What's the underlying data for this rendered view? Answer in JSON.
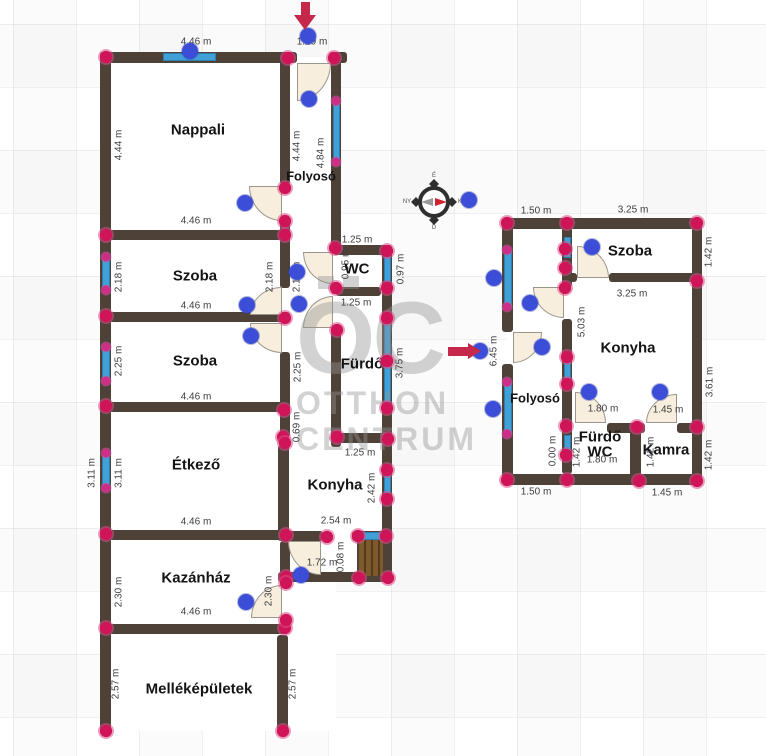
{
  "page": {
    "background": "#ffffff",
    "grid_color": "#ececec",
    "grid_size_px": 63
  },
  "colors": {
    "wall": "#4e4138",
    "window": "#41a0d6",
    "window_border": "#2c7fb0",
    "door_fill": "#f7eedd",
    "door_border": "#9a968c",
    "corner_dot": "#d01458",
    "window_dot": "#cb2f87",
    "handle_dot": "#3c4ed8",
    "arrow": "#c5284a",
    "label_text": "#3d3d3d",
    "room_text": "#141414",
    "watermark": "#949494",
    "stairs": "#7d5a2c",
    "stairs_stripe": "#573a1a"
  },
  "watermark": {
    "monogram": "OC",
    "line1": "OTTHON",
    "line2": "CENTRUM"
  },
  "compass": {
    "north": "É",
    "south": "D",
    "east": "K",
    "west": "NY"
  },
  "floorplan": {
    "interiors": [
      [
        106,
        57,
        230,
        674
      ],
      [
        336,
        245,
        51,
        333
      ],
      [
        507,
        223,
        191,
        258
      ]
    ],
    "walls": [
      [
        100,
        52,
        197,
        11
      ],
      [
        329,
        52,
        18,
        11
      ],
      [
        100,
        52,
        11,
        679
      ],
      [
        100,
        230,
        190,
        10
      ],
      [
        100,
        312,
        190,
        10
      ],
      [
        100,
        402,
        190,
        10
      ],
      [
        100,
        530,
        190,
        10
      ],
      [
        100,
        624,
        188,
        10
      ],
      [
        280,
        52,
        10,
        133
      ],
      [
        280,
        220,
        10,
        68
      ],
      [
        280,
        352,
        10,
        85
      ],
      [
        278,
        445,
        11,
        96
      ],
      [
        280,
        541,
        10,
        44
      ],
      [
        280,
        618,
        10,
        6
      ],
      [
        277,
        635,
        11,
        96
      ],
      [
        331,
        52,
        10,
        198
      ],
      [
        331,
        284,
        10,
        10
      ],
      [
        331,
        328,
        10,
        119
      ],
      [
        333,
        245,
        59,
        10
      ],
      [
        336,
        287,
        45,
        9
      ],
      [
        382,
        245,
        10,
        337
      ],
      [
        331,
        433,
        61,
        10
      ],
      [
        278,
        531,
        45,
        10
      ],
      [
        352,
        531,
        40,
        10
      ],
      [
        278,
        572,
        114,
        10
      ],
      [
        502,
        218,
        200,
        11
      ],
      [
        502,
        218,
        11,
        114
      ],
      [
        502,
        364,
        11,
        121
      ],
      [
        692,
        218,
        10,
        267
      ],
      [
        502,
        474,
        200,
        11
      ],
      [
        562,
        218,
        10,
        69
      ],
      [
        562,
        319,
        10,
        155
      ],
      [
        562,
        273,
        15,
        9
      ],
      [
        609,
        273,
        93,
        9
      ],
      [
        607,
        423,
        38,
        10
      ],
      [
        677,
        423,
        25,
        10
      ],
      [
        630,
        423,
        11,
        62
      ]
    ],
    "windows": [
      [
        163,
        53,
        53,
        8
      ],
      [
        102,
        256,
        8,
        35
      ],
      [
        102,
        346,
        8,
        36
      ],
      [
        102,
        452,
        8,
        37
      ],
      [
        333,
        103,
        7,
        59
      ],
      [
        384,
        252,
        7,
        30
      ],
      [
        384,
        322,
        7,
        38
      ],
      [
        384,
        365,
        7,
        40
      ],
      [
        384,
        470,
        7,
        27
      ],
      [
        356,
        532,
        28,
        8
      ],
      [
        504,
        251,
        8,
        57
      ],
      [
        504,
        382,
        8,
        53
      ],
      [
        564,
        237,
        7,
        21
      ],
      [
        564,
        352,
        7,
        33
      ],
      [
        564,
        435,
        7,
        23
      ]
    ],
    "doors": [
      {
        "x": 297,
        "y": 63,
        "w": 34,
        "h": 38,
        "corner": "br"
      },
      {
        "x": 249,
        "y": 186,
        "w": 33,
        "h": 35,
        "corner": "bl"
      },
      {
        "x": 250,
        "y": 287,
        "w": 32,
        "h": 28,
        "corner": "tl"
      },
      {
        "x": 250,
        "y": 323,
        "w": 32,
        "h": 30,
        "corner": "bl"
      },
      {
        "x": 303,
        "y": 252,
        "w": 30,
        "h": 32,
        "corner": "bl"
      },
      {
        "x": 303,
        "y": 296,
        "w": 30,
        "h": 32,
        "corner": "tl"
      },
      {
        "x": 288,
        "y": 541,
        "w": 33,
        "h": 34,
        "corner": "bl"
      },
      {
        "x": 251,
        "y": 585,
        "w": 31,
        "h": 33,
        "corner": "tl"
      },
      {
        "x": 577,
        "y": 246,
        "w": 32,
        "h": 32,
        "corner": "tr"
      },
      {
        "x": 533,
        "y": 287,
        "w": 31,
        "h": 31,
        "corner": "bl"
      },
      {
        "x": 513,
        "y": 332,
        "w": 29,
        "h": 31,
        "corner": "br"
      },
      {
        "x": 575,
        "y": 392,
        "w": 31,
        "h": 31,
        "corner": "tr"
      },
      {
        "x": 646,
        "y": 394,
        "w": 31,
        "h": 29,
        "corner": "tl"
      }
    ],
    "stairs": {
      "x": 357,
      "y": 534,
      "w": 28,
      "h": 44
    },
    "corner_dots": [
      [
        106,
        57
      ],
      [
        288,
        58
      ],
      [
        334,
        58
      ],
      [
        106,
        235
      ],
      [
        285,
        235
      ],
      [
        285,
        188
      ],
      [
        285,
        221
      ],
      [
        106,
        316
      ],
      [
        285,
        318
      ],
      [
        106,
        406
      ],
      [
        284,
        410
      ],
      [
        283,
        437
      ],
      [
        285,
        443
      ],
      [
        106,
        534
      ],
      [
        286,
        535
      ],
      [
        106,
        628
      ],
      [
        285,
        628
      ],
      [
        106,
        731
      ],
      [
        283,
        731
      ],
      [
        335,
        248
      ],
      [
        336,
        288
      ],
      [
        337,
        330
      ],
      [
        387,
        251
      ],
      [
        387,
        288
      ],
      [
        387,
        318
      ],
      [
        387,
        361
      ],
      [
        387,
        408
      ],
      [
        337,
        437
      ],
      [
        388,
        439
      ],
      [
        387,
        470
      ],
      [
        387,
        499
      ],
      [
        327,
        537
      ],
      [
        358,
        536
      ],
      [
        386,
        536
      ],
      [
        286,
        577
      ],
      [
        359,
        578
      ],
      [
        388,
        578
      ],
      [
        286,
        583
      ],
      [
        286,
        620
      ],
      [
        507,
        223
      ],
      [
        567,
        223
      ],
      [
        697,
        223
      ],
      [
        565,
        249
      ],
      [
        565,
        268
      ],
      [
        565,
        288
      ],
      [
        697,
        281
      ],
      [
        567,
        357
      ],
      [
        567,
        384
      ],
      [
        566,
        426
      ],
      [
        637,
        427
      ],
      [
        697,
        427
      ],
      [
        566,
        455
      ],
      [
        507,
        480
      ],
      [
        567,
        480
      ],
      [
        639,
        481
      ],
      [
        697,
        481
      ]
    ],
    "window_dots": [
      [
        106,
        257
      ],
      [
        106,
        290
      ],
      [
        106,
        347
      ],
      [
        106,
        381
      ],
      [
        106,
        453
      ],
      [
        106,
        488
      ],
      [
        336,
        101
      ],
      [
        336,
        162
      ],
      [
        507,
        250
      ],
      [
        507,
        307
      ],
      [
        507,
        382
      ],
      [
        507,
        434
      ]
    ],
    "handle_dots": [
      [
        190,
        51
      ],
      [
        308,
        36
      ],
      [
        309,
        99
      ],
      [
        245,
        203
      ],
      [
        247,
        305
      ],
      [
        251,
        336
      ],
      [
        297,
        272
      ],
      [
        299,
        304
      ],
      [
        469,
        200
      ],
      [
        480,
        351
      ],
      [
        301,
        575
      ],
      [
        246,
        602
      ],
      [
        494,
        278
      ],
      [
        530,
        303
      ],
      [
        592,
        247
      ],
      [
        542,
        347
      ],
      [
        493,
        409
      ],
      [
        589,
        392
      ],
      [
        660,
        392
      ]
    ],
    "rooms": [
      {
        "name": "Nappali",
        "x": 198,
        "y": 130,
        "small": false
      },
      {
        "name": "Folyosó",
        "x": 311,
        "y": 176,
        "small": true
      },
      {
        "name": "Szoba",
        "x": 195,
        "y": 276,
        "small": false
      },
      {
        "name": "Szoba",
        "x": 195,
        "y": 361,
        "small": false
      },
      {
        "name": "WC",
        "x": 357,
        "y": 269,
        "small": false
      },
      {
        "name": "Fürdő",
        "x": 362,
        "y": 364,
        "small": false
      },
      {
        "name": "Étkező",
        "x": 196,
        "y": 465,
        "small": false
      },
      {
        "name": "Konyha",
        "x": 335,
        "y": 485,
        "small": false
      },
      {
        "name": "Kazánház",
        "x": 196,
        "y": 578,
        "small": false
      },
      {
        "name": "Melléképületek",
        "x": 199,
        "y": 689,
        "small": false
      },
      {
        "name": "Szoba",
        "x": 630,
        "y": 251,
        "small": false
      },
      {
        "name": "Konyha",
        "x": 628,
        "y": 348,
        "small": false
      },
      {
        "name": "Folyosó",
        "x": 535,
        "y": 398,
        "small": true
      },
      {
        "name": "Fürdő",
        "x": 600,
        "y": 437,
        "small": false
      },
      {
        "name": "WC",
        "x": 600,
        "y": 452,
        "small": false
      },
      {
        "name": "Kamra",
        "x": 666,
        "y": 450,
        "small": false
      }
    ],
    "measurements": [
      {
        "text": "4.46 m",
        "x": 196,
        "y": 42,
        "v": false
      },
      {
        "text": "1.29 m",
        "x": 312,
        "y": 42,
        "v": false
      },
      {
        "text": "4.46 m",
        "x": 196,
        "y": 221,
        "v": false
      },
      {
        "text": "4.46 m",
        "x": 196,
        "y": 306,
        "v": false
      },
      {
        "text": "4.46 m",
        "x": 196,
        "y": 397,
        "v": false
      },
      {
        "text": "4.46 m",
        "x": 196,
        "y": 522,
        "v": false
      },
      {
        "text": "4.46 m",
        "x": 196,
        "y": 612,
        "v": false
      },
      {
        "text": "1.25 m",
        "x": 357,
        "y": 240,
        "v": false
      },
      {
        "text": "1.25 m",
        "x": 356,
        "y": 303,
        "v": false
      },
      {
        "text": "1.25 m",
        "x": 360,
        "y": 453,
        "v": false
      },
      {
        "text": "2.54 m",
        "x": 336,
        "y": 521,
        "v": false
      },
      {
        "text": "1.72 m",
        "x": 322,
        "y": 563,
        "v": false
      },
      {
        "text": "4.44 m",
        "x": 119,
        "y": 145,
        "v": true
      },
      {
        "text": "4.44 m",
        "x": 297,
        "y": 146,
        "v": true
      },
      {
        "text": "4.84 m",
        "x": 321,
        "y": 153,
        "v": true
      },
      {
        "text": "2.18 m",
        "x": 119,
        "y": 277,
        "v": true
      },
      {
        "text": "2.18 m",
        "x": 270,
        "y": 277,
        "v": true
      },
      {
        "text": "2.18 m",
        "x": 297,
        "y": 277,
        "v": true
      },
      {
        "text": "2.25 m",
        "x": 119,
        "y": 361,
        "v": true
      },
      {
        "text": "2.25 m",
        "x": 298,
        "y": 367,
        "v": true
      },
      {
        "text": "0.95 m",
        "x": 346,
        "y": 264,
        "v": true
      },
      {
        "text": "0.97 m",
        "x": 401,
        "y": 269,
        "v": true
      },
      {
        "text": "3.75 m",
        "x": 400,
        "y": 363,
        "v": true
      },
      {
        "text": "0.69 m",
        "x": 297,
        "y": 427,
        "v": true
      },
      {
        "text": "3.11 m",
        "x": 92,
        "y": 473,
        "v": true
      },
      {
        "text": "3.11 m",
        "x": 119,
        "y": 473,
        "v": true
      },
      {
        "text": "2.42 m",
        "x": 372,
        "y": 488,
        "v": true
      },
      {
        "text": "0.08 m",
        "x": 341,
        "y": 557,
        "v": true
      },
      {
        "text": "2.30 m",
        "x": 119,
        "y": 592,
        "v": true
      },
      {
        "text": "2.30 m",
        "x": 269,
        "y": 591,
        "v": true
      },
      {
        "text": "2.57 m",
        "x": 116,
        "y": 684,
        "v": true
      },
      {
        "text": "2.57 m",
        "x": 293,
        "y": 684,
        "v": true
      },
      {
        "text": "1.50 m",
        "x": 536,
        "y": 211,
        "v": false
      },
      {
        "text": "3.25 m",
        "x": 633,
        "y": 210,
        "v": false
      },
      {
        "text": "3.25 m",
        "x": 632,
        "y": 294,
        "v": false
      },
      {
        "text": "1.80 m",
        "x": 603,
        "y": 409,
        "v": false
      },
      {
        "text": "1.45 m",
        "x": 668,
        "y": 410,
        "v": false
      },
      {
        "text": "1.80 m",
        "x": 602,
        "y": 460,
        "v": false
      },
      {
        "text": "1.50 m",
        "x": 536,
        "y": 492,
        "v": false
      },
      {
        "text": "1.45 m",
        "x": 667,
        "y": 493,
        "v": false
      },
      {
        "text": "1.42 m",
        "x": 709,
        "y": 252,
        "v": true
      },
      {
        "text": "3.61 m",
        "x": 710,
        "y": 382,
        "v": true
      },
      {
        "text": "1.42 m",
        "x": 709,
        "y": 455,
        "v": true
      },
      {
        "text": "6.45 m",
        "x": 494,
        "y": 351,
        "v": true
      },
      {
        "text": "5.03 m",
        "x": 582,
        "y": 322,
        "v": true
      },
      {
        "text": "0.00 m",
        "x": 553,
        "y": 451,
        "v": true
      },
      {
        "text": "1.42 m",
        "x": 577,
        "y": 452,
        "v": true
      },
      {
        "text": "1.42 m",
        "x": 651,
        "y": 452,
        "v": true
      }
    ]
  }
}
